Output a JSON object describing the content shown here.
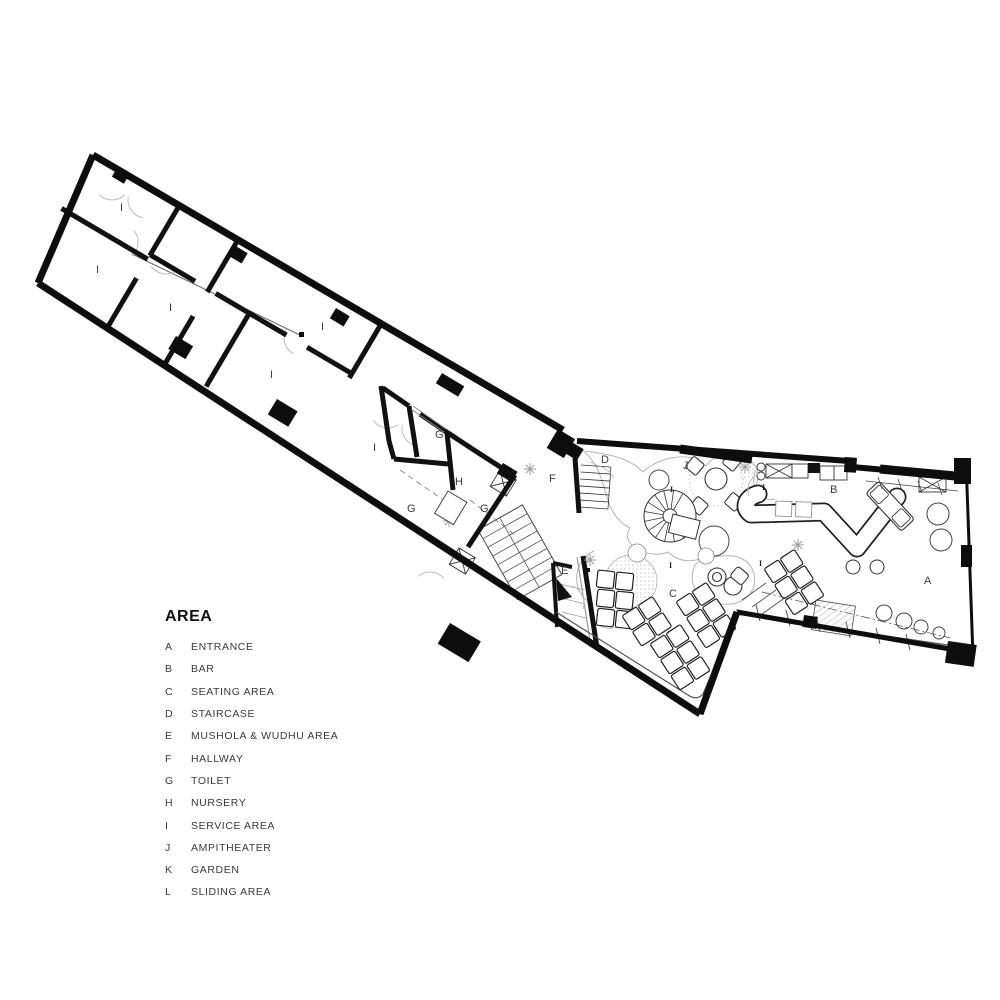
{
  "legend": {
    "title": "AREA",
    "items": [
      {
        "key": "A",
        "label": "ENTRANCE"
      },
      {
        "key": "B",
        "label": "BAR"
      },
      {
        "key": "C",
        "label": "SEATING AREA"
      },
      {
        "key": "D",
        "label": "STAIRCASE"
      },
      {
        "key": "E",
        "label": "MUSHOLA & WUDHU AREA"
      },
      {
        "key": "F",
        "label": "HALLWAY"
      },
      {
        "key": "G",
        "label": "TOILET"
      },
      {
        "key": "H",
        "label": "NURSERY"
      },
      {
        "key": "I",
        "label": "SERVICE AREA"
      },
      {
        "key": "J",
        "label": "AMPITHEATER"
      },
      {
        "key": "K",
        "label": "GARDEN"
      },
      {
        "key": "L",
        "label": "SLIDING AREA"
      }
    ]
  },
  "plan": {
    "labels": [
      {
        "text": "A",
        "x": 924,
        "y": 584
      },
      {
        "text": "B",
        "x": 830,
        "y": 493
      },
      {
        "text": "C",
        "x": 669,
        "y": 597
      },
      {
        "text": "D",
        "x": 601,
        "y": 463
      },
      {
        "text": "E",
        "x": 561,
        "y": 574
      },
      {
        "text": "F",
        "x": 549,
        "y": 482
      },
      {
        "text": "G",
        "x": 435,
        "y": 438
      },
      {
        "text": "G",
        "x": 407,
        "y": 512
      },
      {
        "text": "G",
        "x": 480,
        "y": 512
      },
      {
        "text": "H",
        "x": 455,
        "y": 485
      },
      {
        "text": "J",
        "x": 683,
        "y": 469
      },
      {
        "text": "I",
        "x": 120,
        "y": 211
      },
      {
        "text": "I",
        "x": 96,
        "y": 273
      },
      {
        "text": "I",
        "x": 169,
        "y": 311
      },
      {
        "text": "I",
        "x": 321,
        "y": 330
      },
      {
        "text": "I",
        "x": 270,
        "y": 378
      },
      {
        "text": "I",
        "x": 373,
        "y": 451
      },
      {
        "text": "I",
        "x": 670,
        "y": 492,
        "small": true
      },
      {
        "text": "I",
        "x": 762,
        "y": 490,
        "small": true
      },
      {
        "text": "I",
        "x": 669,
        "y": 568,
        "small": true
      },
      {
        "text": "I",
        "x": 759,
        "y": 566,
        "small": true
      }
    ]
  },
  "colors": {
    "ink": "#111111",
    "light_line": "#bbbbbb",
    "mid_line": "#555555"
  }
}
